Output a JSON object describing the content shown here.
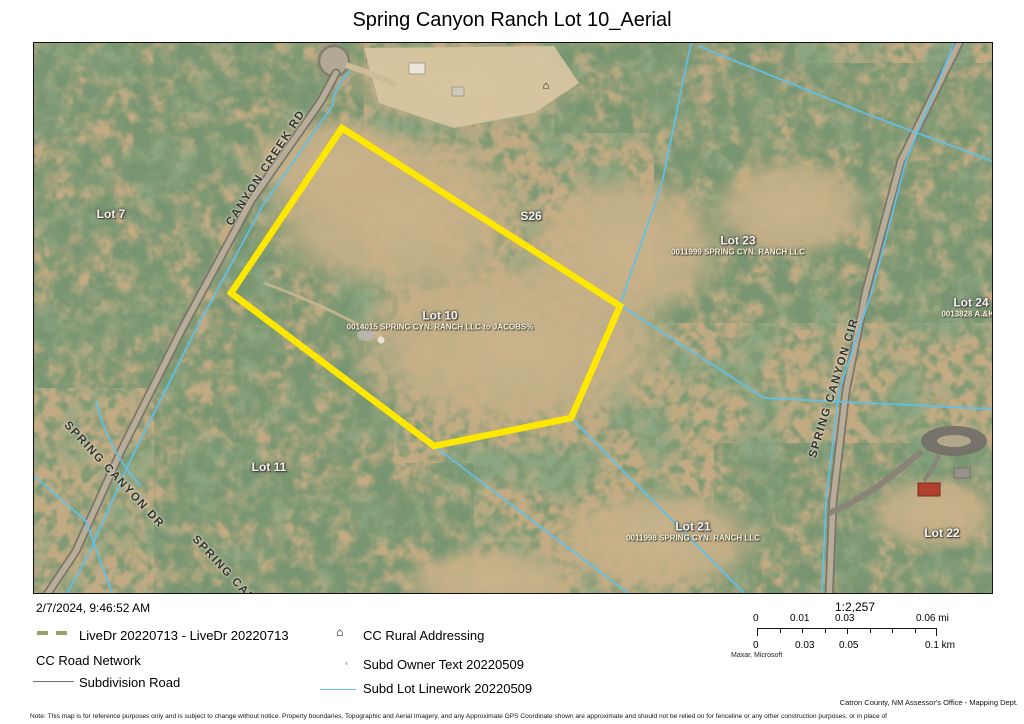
{
  "title": "Spring Canyon Ranch Lot 10_Aerial",
  "map": {
    "lots": [
      {
        "name": "Lot 7",
        "owner": ""
      },
      {
        "name": "S26",
        "owner": ""
      },
      {
        "name": "Lot 23",
        "owner": "0011999 SPRING CYN. RANCH LLC"
      },
      {
        "name": "Lot 24",
        "owner": "0013828 A.&K. I"
      },
      {
        "name": "Lot 10",
        "owner": "0014015 SPRING CYN. RANCH LLC to JACOBS%"
      },
      {
        "name": "Lot 11",
        "owner": ""
      },
      {
        "name": "Lot 21",
        "owner": "0011998 SPRING CYN. RANCH LLC"
      },
      {
        "name": "Lot 22",
        "owner": ""
      }
    ],
    "roads": [
      {
        "name": "CANYON CREEK RD"
      },
      {
        "name": "SPRING CANYON DR"
      },
      {
        "name": "SPRING CANYON DR"
      },
      {
        "name": "SPRING CANYON CIR"
      }
    ],
    "address_point_icon": "house-icon"
  },
  "legend": {
    "timestamp": "2/7/2024, 9:46:52 AM",
    "items_left": [
      {
        "symbol": "dashed-olive-line",
        "label": "LiveDr 20220713 - LiveDr 20220713"
      },
      {
        "symbol": "none",
        "label": "CC Road Network"
      },
      {
        "symbol": "gray-line",
        "label": "Subdivision Road"
      }
    ],
    "items_right": [
      {
        "symbol": "house-icon",
        "label": "CC Rural Addressing"
      },
      {
        "symbol": "text-dot",
        "label": "Subd Owner Text 20220509"
      },
      {
        "symbol": "cyan-line",
        "label": "Subd Lot Linework 20220509"
      }
    ]
  },
  "scalebar": {
    "ratio": "1:2,257",
    "mi_labels": [
      "0",
      "0.01",
      "0.03",
      "0.06 mi"
    ],
    "km_labels": [
      "0",
      "0.03",
      "0.05",
      "0.1 km"
    ],
    "credit": "Maxar, Microsoft"
  },
  "footer": {
    "attribution": "Catron County, NM Assessor's Office - Mapping Dept.",
    "note": "Note: This map is for reference purposes only and is subject to change without notice. Property boundaries, Topographic and Aerial Imagery, and any Approximate GPS Coordinate shown are approximate and should not be relied on for fenceline or any other construction purposes, or in place of"
  },
  "colors": {
    "lot_highlight_yellow": "#ffe800",
    "lot_linework_cyan": "#5ec1ec",
    "livedr_olive": "#9aa06b",
    "subdivision_road_gray": "#6b7070"
  }
}
